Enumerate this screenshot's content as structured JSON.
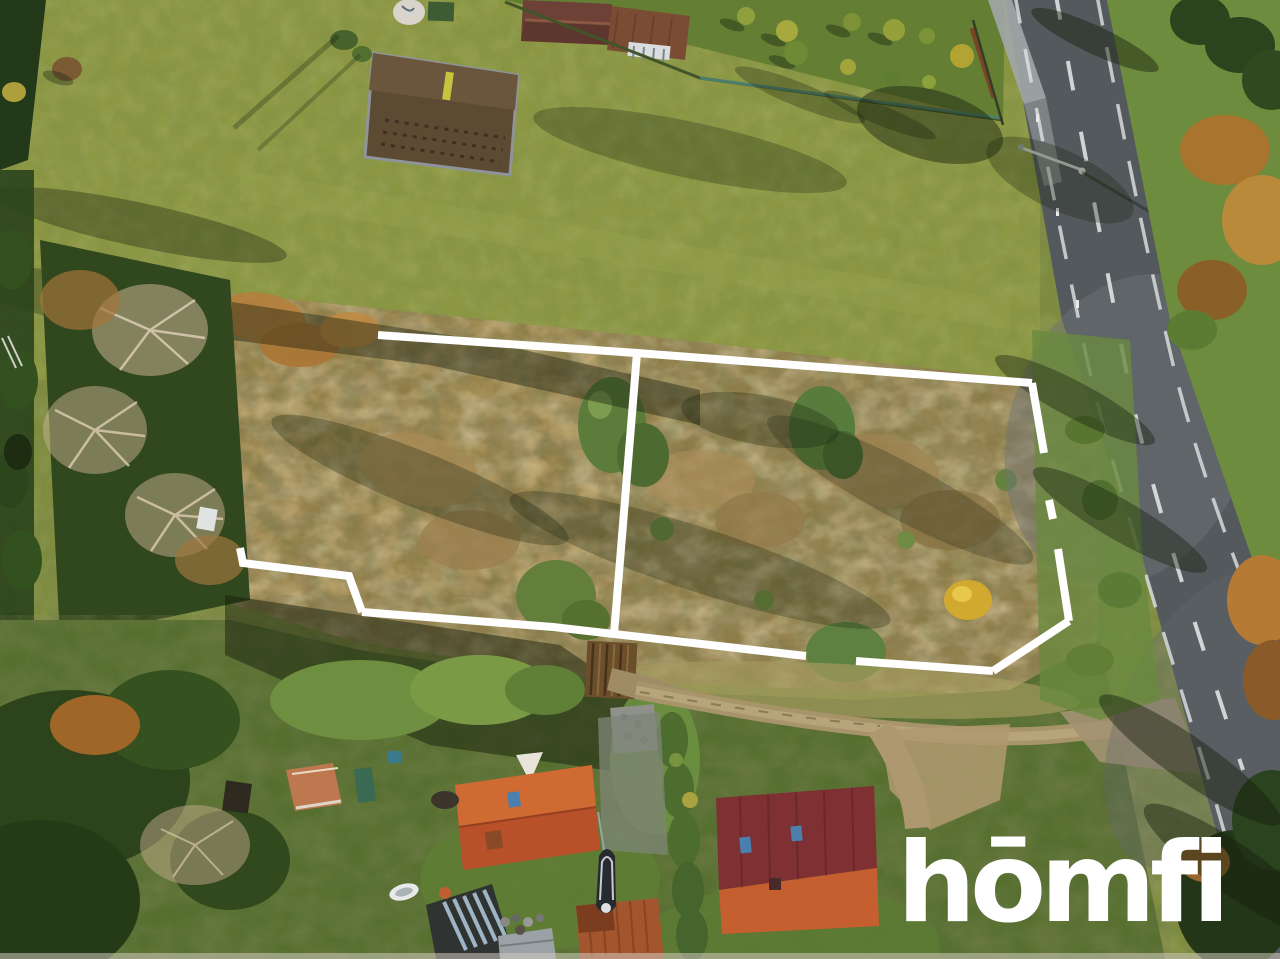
{
  "scene": {
    "description": "Aerial drone photo of a vacant autumn land plot outlined with a white property-boundary overlay, next to an asphalt road, houses and gardens below",
    "season": "autumn",
    "overlay_color": "#ffffff",
    "road_marking_color": "#ffffff",
    "road_surface_color": "#54595d",
    "field_green": "#8b9743",
    "brush_tan": "#8f7d49"
  },
  "watermark": {
    "text": "hōmfi",
    "color": "#ffffff"
  },
  "boundary": {
    "stroke": "#ffffff",
    "stroke_width": 8,
    "top_edge": "378,335 637,353 1032,383",
    "right_seg_a": "1032,383 1044,453",
    "right_seg_b": "1049,500 1053,519",
    "right_seg_c": "1058,549 1069,621",
    "corner_diag": "1069,621 993,671",
    "bottom_right": "993,671 856,661",
    "bottom_left": "806,656 614,634 553,627 362,612",
    "step": "362,612 349,576 243,563 240,548",
    "divider": "637,353 614,634"
  }
}
